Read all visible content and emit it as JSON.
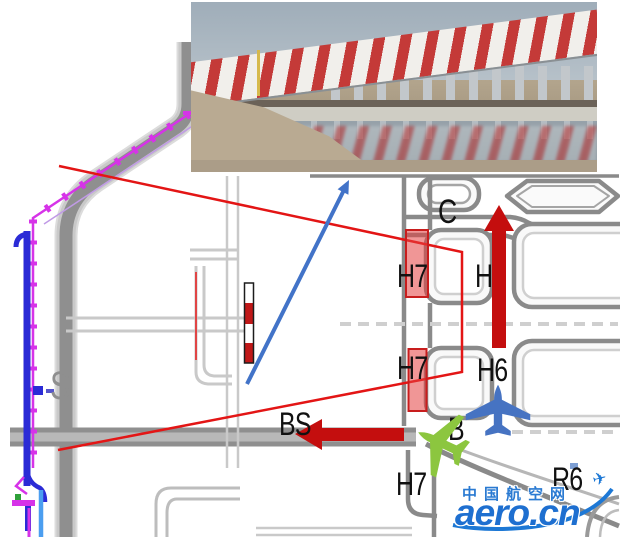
{
  "page": {
    "type": "airport-taxiway-closure-notice-graphic"
  },
  "photo": {
    "subject": "red-white striped barrier fence on piers reflected in a water channel",
    "stripe_red": "#c43a38",
    "stripe_white": "#f1efeb",
    "sky": "#a7b3bd",
    "water": "#8a97a0",
    "ground": "#b7a890"
  },
  "map": {
    "labels": {
      "c": "C",
      "h7_upper": "H7",
      "h6_upper": "H6",
      "h7_mid": "H7",
      "h6_mid": "H6",
      "b": "B",
      "bs": "BS",
      "h7_lower": "H7",
      "r6": "R6",
      "s": "S"
    }
  },
  "watermark": {
    "site_name": "中国航空网",
    "domain": "aero.cn",
    "color": "#1d78d5"
  },
  "colors": {
    "closure_fill": "rgba(228,64,64,0.55)",
    "closure_border": "#c81d1d",
    "direction_arrow_red": "#c40e0e",
    "callout_red": "#e31515",
    "pointer_blue": "#4273c8",
    "aircraft_blue": "#4673c2",
    "aircraft_green": "#8cc63f",
    "boundary_magenta": "#d633e8",
    "boundary_blue": "#2b2bd6",
    "boundary_lightblue": "#4b9ef0",
    "road_gray": "#8a8a8a",
    "marker_red": "#c01818"
  }
}
